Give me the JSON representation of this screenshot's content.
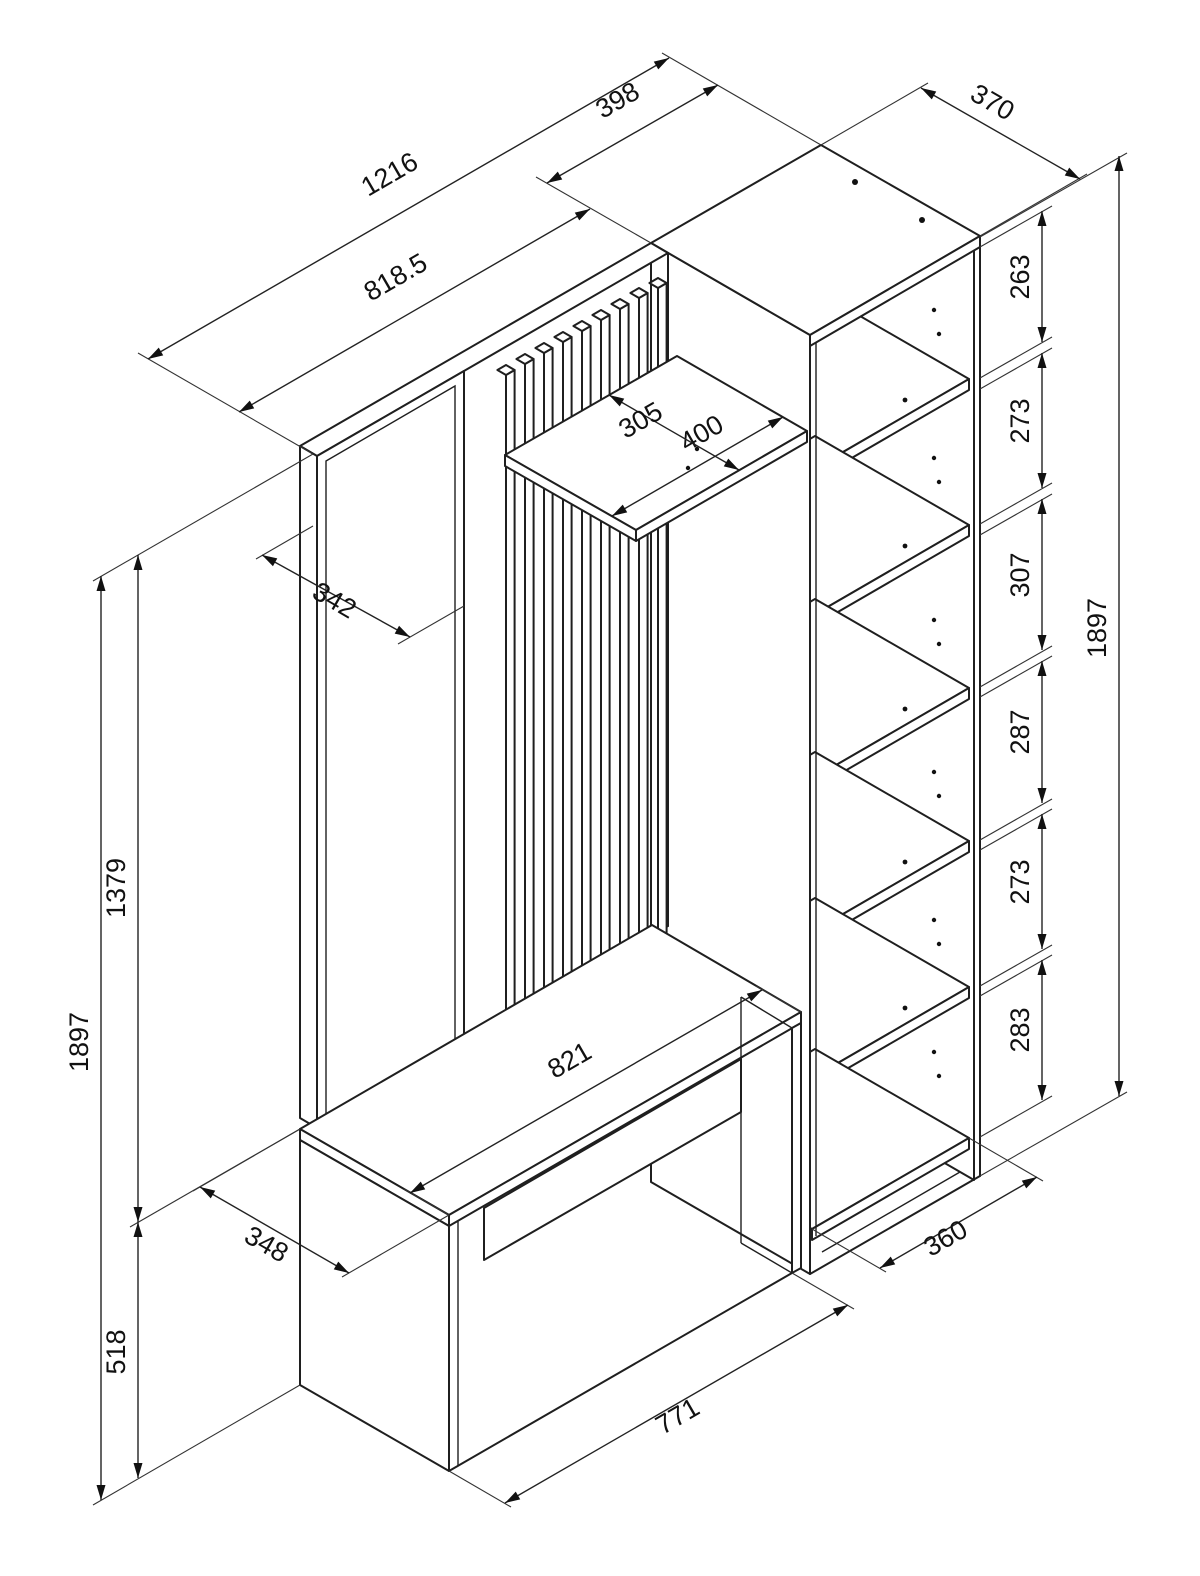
{
  "page": {
    "background": "#ffffff",
    "line_color": "#1f1f1f",
    "text_color": "#111111"
  },
  "drawing": {
    "type": "isometric-technical-drawing",
    "subject": "Hallway furniture set: mirror panel, slat wall panel with shelf, bench with drawer, and open shelving column",
    "units": "mm"
  },
  "dims": {
    "overall_width": "1216",
    "unit_width": "398",
    "panel_width": "818.5",
    "unit_depth_top": "370",
    "shelf_depth": "305",
    "shelf_width": "400",
    "mirror_width": "342",
    "comp_1": "263",
    "comp_2": "273",
    "comp_3": "307",
    "comp_4": "287",
    "comp_5": "273",
    "comp_6": "283",
    "unit_height": "1897",
    "total_height": "1897",
    "panel_height": "1379",
    "bench_height": "518",
    "bench_depth": "348",
    "bench_top_width": "821",
    "bench_bottom_width": "771",
    "unit_depth_bottom": "360"
  }
}
